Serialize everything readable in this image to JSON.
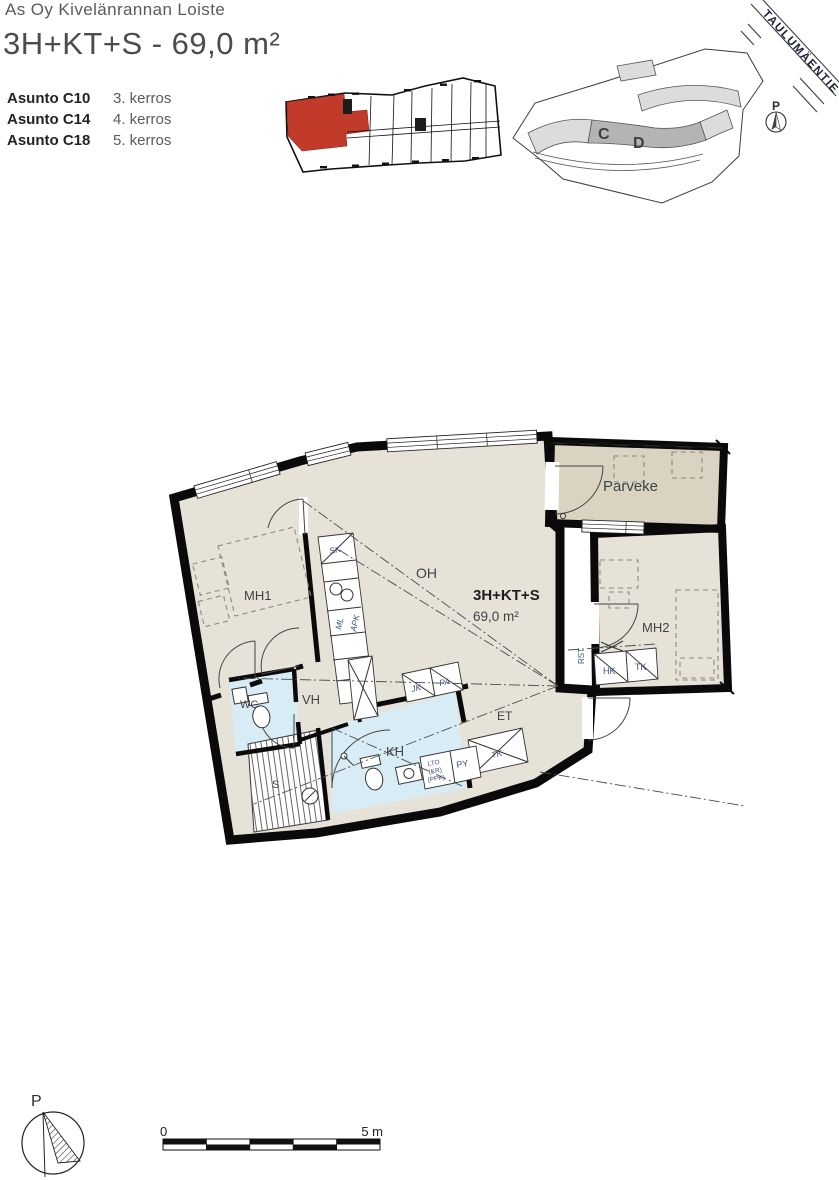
{
  "header": {
    "project_name": "As Oy Kivelänrannan Loiste",
    "type_title": "3H+KT+S - 69,0 m²",
    "apartments": [
      {
        "unit": "Asunto C10",
        "floor": "3. kerros"
      },
      {
        "unit": "Asunto C14",
        "floor": "4. kerros"
      },
      {
        "unit": "Asunto C18",
        "floor": "5. kerros"
      }
    ]
  },
  "site_plan": {
    "street_name": "TAULUMÄENTIE",
    "building_c": "C",
    "building_d": "D",
    "north_label": "P"
  },
  "floor_plan": {
    "type_label": "3H+KT+S",
    "area_label": "69,0 m²",
    "room_labels": {
      "mh1": "MH1",
      "oh": "OH",
      "mh2": "MH2",
      "vh": "VH",
      "wc": "WC",
      "kh": "KH",
      "s": "S",
      "et": "ET",
      "parveke": "Parveke"
    },
    "fixture_labels": {
      "sk": "SK",
      "ml": "ML",
      "apk": "APK",
      "jk": "JK",
      "pa": "PA",
      "hk": "HK",
      "tk": "TK",
      "rst": "RST",
      "lto": "LTO",
      "kr": "(KR)",
      "ppk": "(PPK)",
      "py": "PY",
      "tk_entry": "TK"
    }
  },
  "compass": {
    "north_label": "P"
  },
  "scale_bar": {
    "start_label": "0",
    "end_label": "5 m"
  },
  "colors": {
    "floor_beige": "#e7e2d7",
    "balcony_taupe": "#dbd3c1",
    "wet_room_blue": "#d8ecf5",
    "highlight_red": "#c13a2a",
    "site_building_gray": "#dcdcdc",
    "site_cd_gray": "#b4b4b4"
  }
}
